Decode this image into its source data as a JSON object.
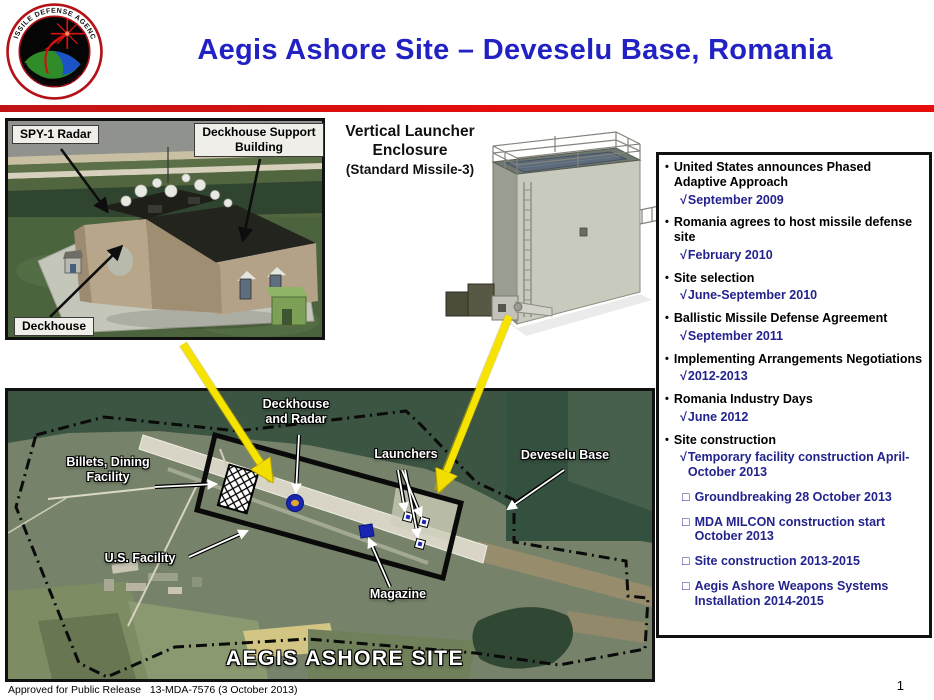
{
  "header": {
    "title": "Aegis Ashore Site – Deveselu Base, Romania",
    "logo_top_text": "MISSILE DEFENSE AGENCY",
    "logo_bottom_text": "DEPARTMENT OF DEFENSE",
    "colors": {
      "title": "#2121C4",
      "divider": "#E60D0D"
    }
  },
  "figures": {
    "deckhouse": {
      "spy1_label": "SPY-1 Radar",
      "support_label": "Deckhouse Support\nBuilding",
      "deckhouse_label": "Deckhouse"
    },
    "launcher": {
      "title_line1": "Vertical Launcher",
      "title_line2": "Enclosure",
      "subtitle": "(Standard Missile-3)"
    }
  },
  "timeline": {
    "bullet_glyph": "•",
    "check_glyph": "√",
    "box_glyph": "□",
    "text_color": "#000000",
    "accent_color": "#23238E",
    "items": [
      {
        "text": "United States announces Phased Adaptive Approach",
        "subs": [
          {
            "type": "done",
            "text": "September 2009"
          }
        ]
      },
      {
        "text": "Romania agrees to host missile defense site",
        "subs": [
          {
            "type": "done",
            "text": "February 2010"
          }
        ]
      },
      {
        "text": "Site selection",
        "subs": [
          {
            "type": "done",
            "text": "June-September 2010"
          }
        ]
      },
      {
        "text": "Ballistic Missile Defense Agreement",
        "subs": [
          {
            "type": "done",
            "text": "September 2011"
          }
        ]
      },
      {
        "text": "Implementing Arrangements Negotiations",
        "subs": [
          {
            "type": "done",
            "text": "2012-2013"
          }
        ]
      },
      {
        "text": "Romania Industry Days",
        "subs": [
          {
            "type": "done",
            "text": "June 2012"
          }
        ]
      },
      {
        "text": "Site construction",
        "subs": [
          {
            "type": "done",
            "text": "Temporary facility construction April-October 2013"
          },
          {
            "type": "planned",
            "text": "Groundbreaking 28 October 2013"
          },
          {
            "type": "planned",
            "text": "MDA MILCON construction start October 2013"
          },
          {
            "type": "planned",
            "text": "Site construction 2013-2015"
          },
          {
            "type": "planned",
            "text": "Aegis Ashore Weapons Systems Installation 2014-2015"
          }
        ]
      }
    ]
  },
  "map": {
    "labels": {
      "deckhouse_radar": "Deckhouse\nand Radar",
      "billets": "Billets, Dining\nFacility",
      "launchers": "Launchers",
      "deveselu_base": "Deveselu Base",
      "us_facility": "U.S. Facility",
      "magazine": "Magazine",
      "site_title": "AEGIS ASHORE SITE"
    }
  },
  "slide": {
    "footer": "Approved for Public Release   13-MDA-7576 (3 October 2013)",
    "page_number": "1"
  }
}
